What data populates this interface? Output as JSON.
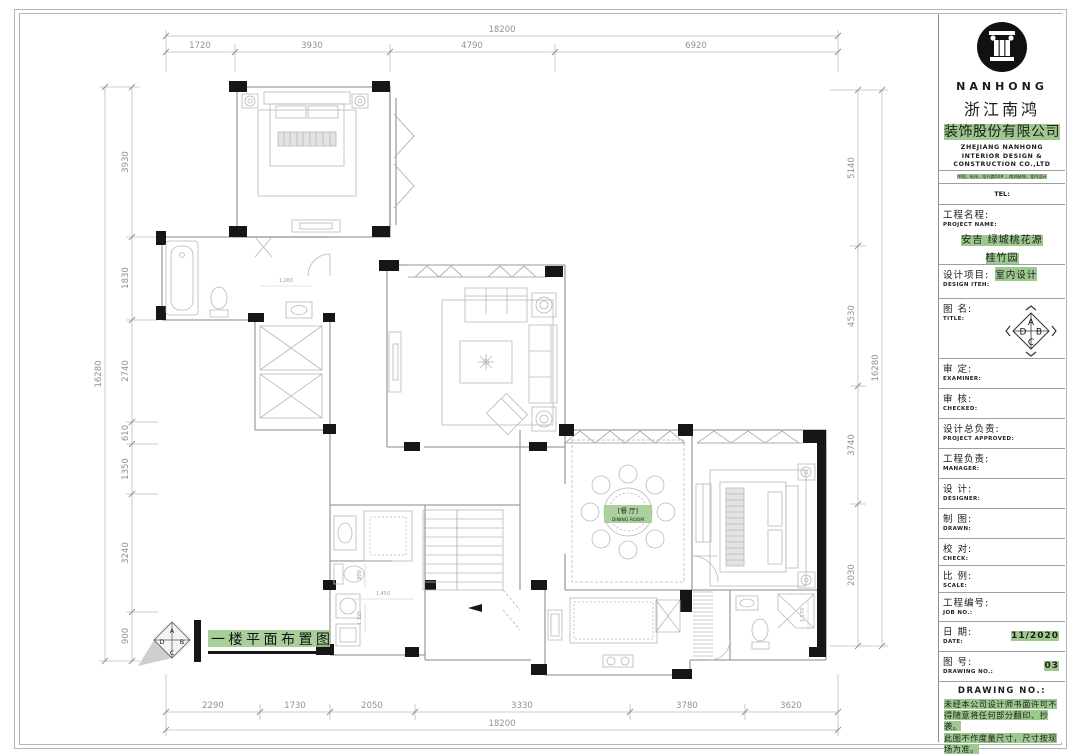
{
  "sheet": {
    "plan_title": "一楼平面布置图",
    "dining_cn": "[餐 厅]",
    "dining_en": "DINING ROOM"
  },
  "compass": {
    "top": "A",
    "right": "B",
    "bottom": "C",
    "left": "D"
  },
  "dims": {
    "top_total": "18200",
    "top": [
      "1720",
      "3930",
      "4790",
      "6920"
    ],
    "bottom": [
      "2290",
      "1730",
      "2050",
      "3330",
      "3780",
      "3620"
    ],
    "bottom_total": "18200",
    "left": [
      "3930",
      "1830",
      "2740",
      "610",
      "1350",
      "3240",
      "900"
    ],
    "left_total": "16280",
    "right": [
      "5140",
      "4530",
      "3740",
      "2030"
    ],
    "right_total": "16280",
    "inner": {
      "sink": "1,260",
      "w": "1,450",
      "d": "800",
      "h": "1,125",
      "r": "1,570"
    }
  },
  "tb": {
    "brand": "NANHONG",
    "cn1": "浙江南鸿",
    "cn2": "装饰股份有限公司",
    "en1": "ZHEJIANG NANHONG",
    "en2": "INTERIOR DESIGN &",
    "en3": "CONSTRUCTION CO.,LTD",
    "address": "中国，杭州，绍兴路50# ，南鸿装饰，室内设计",
    "tel": "TEL:",
    "project_cn": "工程名程:",
    "project_en": "PROJECT NAME:",
    "project_v1": "安吉 绿城桃花源",
    "project_v2": "桂竹园",
    "design_cn": "设计项目:",
    "design_v": "室内设计",
    "design_en": "DESIGN ITEH:",
    "title_cn": "图 名:",
    "title_en": "TITLE:",
    "examiner_cn": "审  定:",
    "examiner_en": "EXAMINER:",
    "checked_cn": "审  核:",
    "checked_en": "CHECKED:",
    "approved_cn": "设计总负责:",
    "approved_en": "PROJECT APPROVED:",
    "manager_cn": "工程负责:",
    "manager_en": "MANAGER:",
    "designer_cn": "设  计:",
    "designer_en": "DESIGNER:",
    "drawn_cn": "制  图:",
    "drawn_en": "DRAWN:",
    "check_cn": "校  对:",
    "check_en": "CHECK:",
    "scale_cn": "比  例:",
    "scale_en": "SCALE:",
    "job_cn": "工程编号:",
    "job_en": "JOB NO.:",
    "date_cn": "日  期:",
    "date_en": "DATE:",
    "date_v": "11/2020",
    "dwg_cn": "图  号:",
    "dwg_en": "DRAWING NO.:",
    "dwg_v": "03",
    "notes_header": "DRAWING NO.:",
    "note1": "未经本公司设计师书面许可不得随意将任何部分翻印、抄袭。",
    "note2": "此图不作度量尺寸，尺寸按现场为准。",
    "note3": "若有不明之处，应立即通知设计师。"
  },
  "colors": {
    "highlight": "#9ec98e",
    "wall_line": "#9aa0a4",
    "dim_text": "#8d9296",
    "column_fill": "#161616"
  }
}
